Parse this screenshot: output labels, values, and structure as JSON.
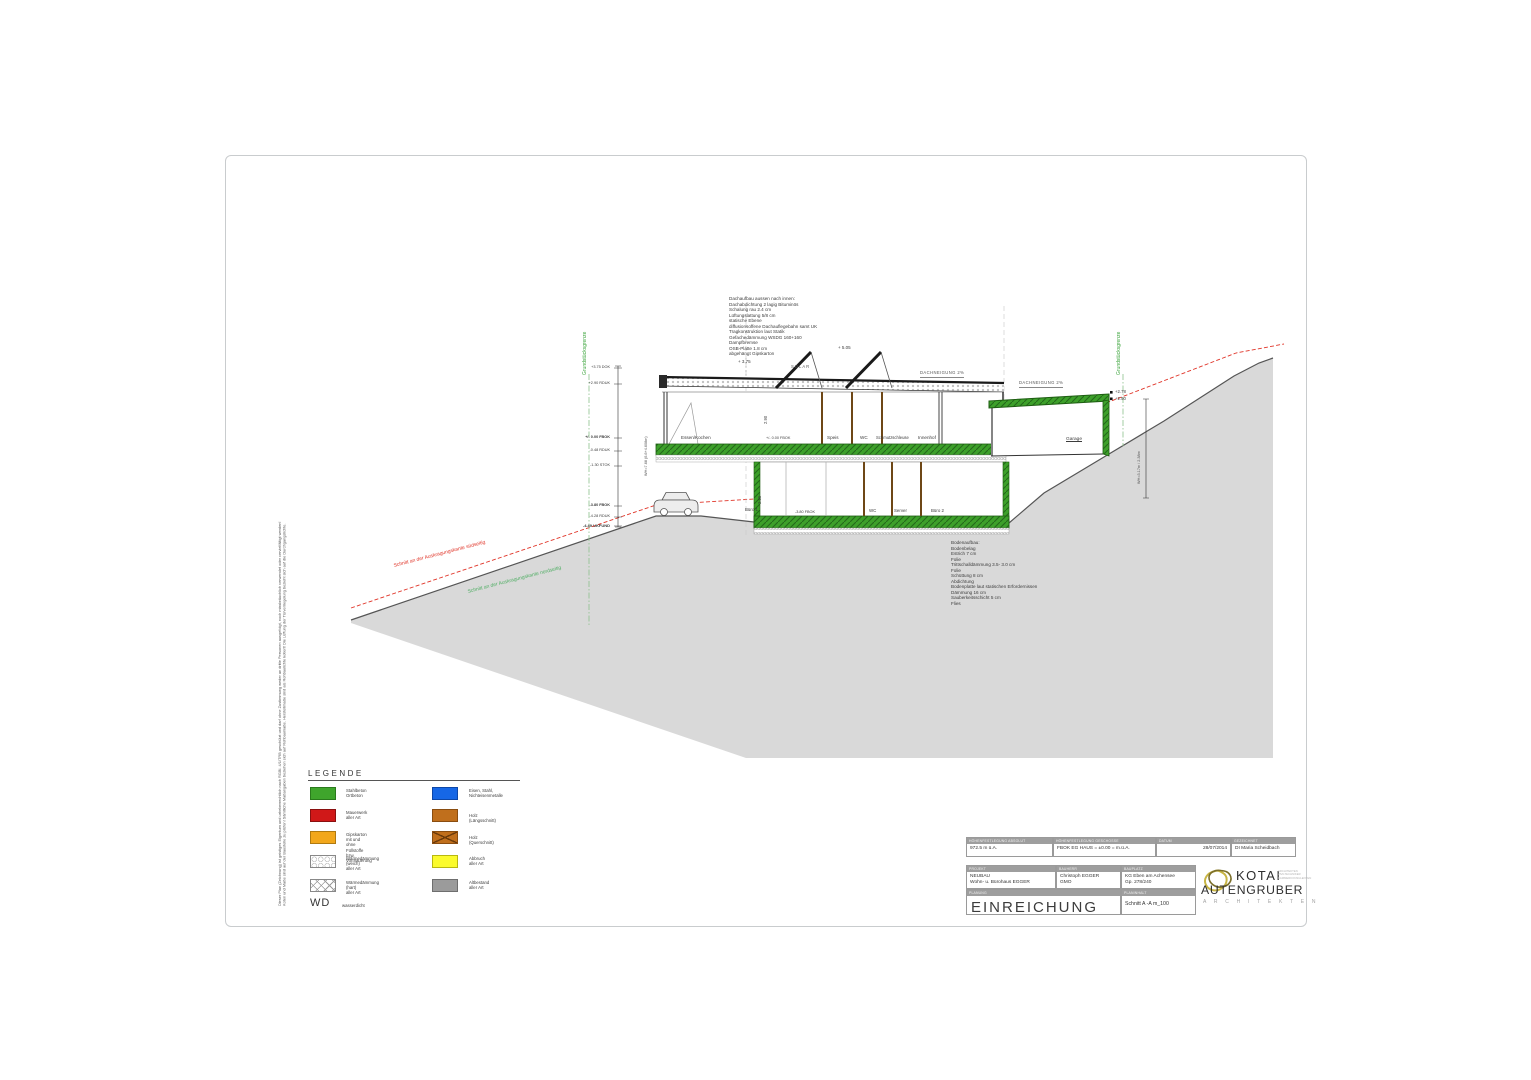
{
  "drawing": {
    "property_left": "Grundstücksgrenze",
    "property_right": "Grundstücksgrenze",
    "cut_red": "Schnitt an der Auskragungskante südseitig",
    "cut_green": "Schnitt an der Auskragungskante nordseitig",
    "roof_buildup": [
      "Dachaufbau aussen nach innen:",
      "Dachabdichtung 2 lagig Bituminös",
      "Schalung rau 2.4 cm",
      "Lüftungslattung 5/8 cm",
      "statische Ebene",
      "diffusionsoffene Dachauflegebahn samt UK",
      "Tragkonstruktion laut Statik",
      "Gefachedämmung WSDG 160+160",
      "Dampfbremse",
      "OSB-Platte 1.8 cm",
      "abgehängt Gipskarton"
    ],
    "floor_buildup": [
      "Bodenaufbau:",
      "Bodenbelag",
      "Estrich 7 cm",
      "Folie",
      "Trittschalldämmung 3.5- 3.0 cm",
      "Folie",
      "Schüttung 8 cm",
      "Abdichtung",
      "Bodenplatte laut statischen Erfordernissen",
      "Dämmung 16 cm",
      "Sauberkeitsschicht 5 cm",
      "Flies"
    ],
    "solar": "SOLAR",
    "slope_roof": "DACHNEIGUNG 2%",
    "slope_garage": "DACHNEIGUNG 2%",
    "lvl_505": "+ 5.05",
    "lvl_375": "+ 3.75",
    "lvl_278": "+2.78",
    "lvl_250": "+2.50",
    "eg_level": "+/- 0.00 FBOK",
    "ug_level": "-3.80 FBOK",
    "wh_left": "WH=7.68 (6.6+4.608m)",
    "wh_right": "WH=3.17m / 2.38m",
    "h_eg": "2.90",
    "h_ug": "2.35",
    "levels": [
      "+3.75 DOK",
      "+2.90 RDUK",
      "+/- 0.00 FBOK",
      "-0.48 RDUK",
      "-1.30 STOK",
      "-3.80 FBOK",
      "-4.28 RDUK",
      "-4.49 UKFUND"
    ],
    "rooms_eg": [
      "Essen/Kochen",
      "Speis",
      "WC",
      "Schmutzschleuse",
      "Innenhof",
      "Garage"
    ],
    "rooms_ug": [
      "Büro 1",
      "WC",
      "Server",
      "Büro 2"
    ]
  },
  "legend": {
    "title": "LEGENDE",
    "items_left": [
      {
        "label": "Stahlbeton\nOrtbeton"
      },
      {
        "label": "Mauerwerk\naller Art"
      },
      {
        "label": "Gipskarton mit und\nohne Füllstoffe bzw. Vormauerung"
      },
      {
        "label": "Wärmedämmung (weich)\naller Art"
      },
      {
        "label": "Wärmedämmung (hart)\naller Art"
      }
    ],
    "items_right": [
      {
        "label": "Eisen, Stahl,\nNichteisenmetalle"
      },
      {
        "label": "Holz (Längsschnitt)"
      },
      {
        "label": "Holz (Querschnitt)"
      },
      {
        "label": "Abbruch\naller Art"
      },
      {
        "label": "Altbestand\naller Art"
      }
    ],
    "wd_abbr": "WD",
    "wd_label": "wasserdicht"
  },
  "titleblock": {
    "row1": [
      {
        "header": "HÖHENFESTLEGUNG ABSOLUT",
        "value": "972.5 m ü.A."
      },
      {
        "header": "HÖHENFESTLEGUNG GESCHOSSE",
        "value": "FBOK EG HAUS = ±0.00 = m.ü.A."
      },
      {
        "header": "DATUM",
        "value": "28/07/2014"
      },
      {
        "header": "GEZEICHNET",
        "value": "DI Maria Scheidbach"
      }
    ],
    "row2": [
      {
        "header": "PROJEKT",
        "value": "NEUBAU\nWohn- u. Bürohaus EGGER"
      },
      {
        "header": "BAUHERR",
        "value": "Christoph EGGER\nGMO"
      },
      {
        "header": "BAUPLATZ",
        "value": "KG Eben am Achensee\nGp. 278/240"
      }
    ],
    "row3": {
      "planung_header": "PLANUNG",
      "planung_value": "EINREICHUNG",
      "planinhalt_header": "PLANINHALT",
      "planinhalt_value": "Schnitt A -A   m_100"
    }
  },
  "logo": {
    "name_top": "KOTAI",
    "name_bottom": "AUTENGRUBER",
    "subtitle": "A R C H I T E K T E N",
    "side_lines": [
      "ARCHITEKTEN",
      "ZIVILTECHNIKER",
      "KAMMERKONSULENTEN"
    ]
  },
  "disclaimer": [
    "Dieser Plan (Zeichnung) ist geistiges Eigentum und urheberrechtlich nach RGBl. 4/1/TRB geschützt und darf ohne Zustimmung weder an dritte Personen ausgefolgt, noch missbräuchlich verwendet oder vervielfältigt werden!",
    "Koten und Maße sind auf der Baustelle zu prüfen! Sämtliche Maßangaben beziehen sich auf Rohbaumaße. Herstellmaße sind als Rohbaulichte kotiert! Die Lüftung der Türverriegelung bezieht sich auf die Durchgangslichte."
  ]
}
